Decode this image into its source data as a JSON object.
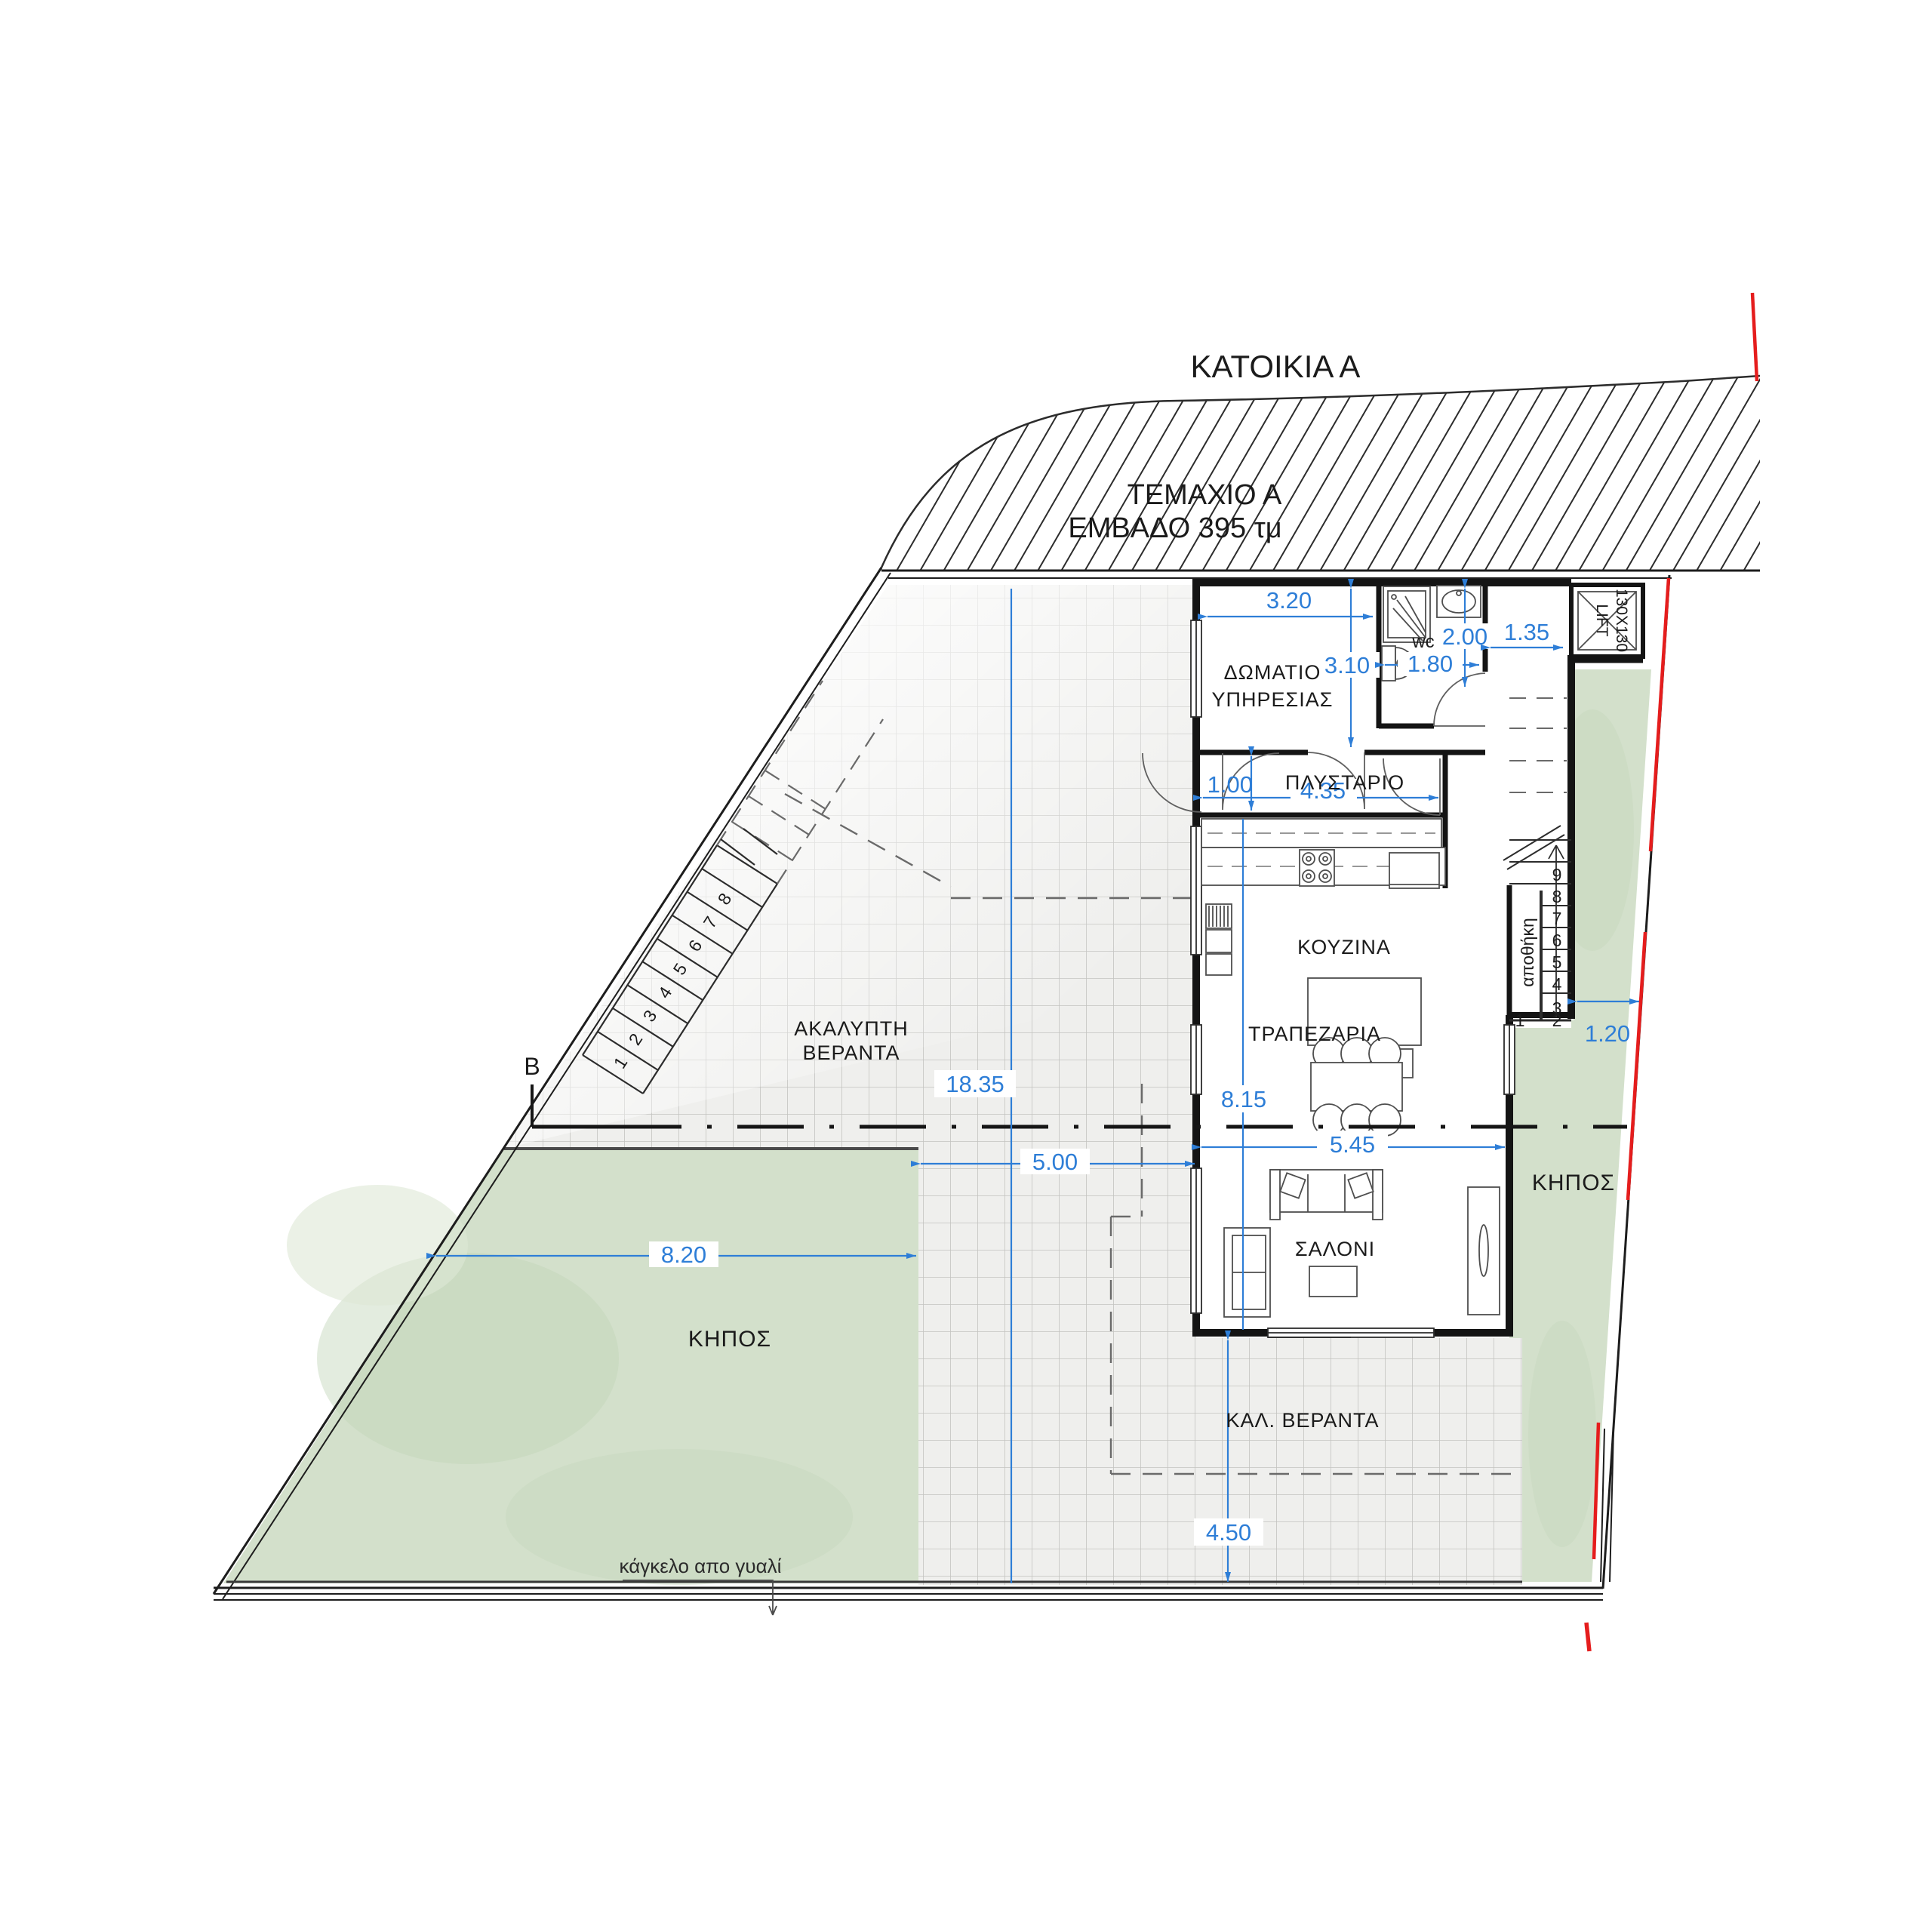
{
  "title": "ΚΑΤΟΙΚΙΑ Α",
  "plot_label": {
    "line1": "ΤΕΜΑΧΙΟ Α",
    "line2": "ΕΜΒΑΔΟ 395 τμ"
  },
  "rooms": {
    "service_line1": "ΔΩΜΑΤΙΟ",
    "service_line2": "ΥΠΗΡΕΣΙΑΣ",
    "wc": "wc",
    "laundry": "ΠΛΥΣΤΑΡΙΟ",
    "kitchen": "ΚΟΥΖΙΝΑ",
    "dining": "ΤΡΑΠΕΖΑΡΙΑ",
    "living": "ΣΑΛΟΝΙ",
    "veranda_open_line1": "ΑΚΑΛΥΠΤΗ",
    "veranda_open_line2": "ΒΕΡΑΝΤΑ",
    "veranda_covered": "ΚΑΛ. ΒΕΡΑΝΤΑ",
    "garden_left": "ΚΗΠΟΣ",
    "garden_right": "ΚΗΠΟΣ",
    "storage": "αποθήκη",
    "lift_line1": "130X130",
    "lift_line2": "LIFT"
  },
  "dimensions": {
    "w320": "3.20",
    "h310": "3.10",
    "w200": "2.00",
    "w180": "1.80",
    "w135": "1.35",
    "h100": "1.00",
    "w435": "4.35",
    "h1835": "18.35",
    "h815": "8.15",
    "w545": "5.45",
    "w500": "5.00",
    "w820": "8.20",
    "w120": "1.20",
    "h450": "4.50"
  },
  "stairs": {
    "interior": [
      "1",
      "2",
      "3",
      "4",
      "5",
      "6",
      "7",
      "8",
      "9"
    ],
    "exterior": [
      "1",
      "2",
      "3",
      "4",
      "5",
      "6",
      "7",
      "8"
    ]
  },
  "annotations": {
    "railing_note": "κάγκελο απο γυαλί",
    "section_marker": "B"
  },
  "colors": {
    "dimension_blue": "#2e7ed7",
    "boundary_red": "#e51d1d",
    "garden_green": "#d3e0cb",
    "tile_gray": "#efefed",
    "wall_black": "#141414"
  }
}
